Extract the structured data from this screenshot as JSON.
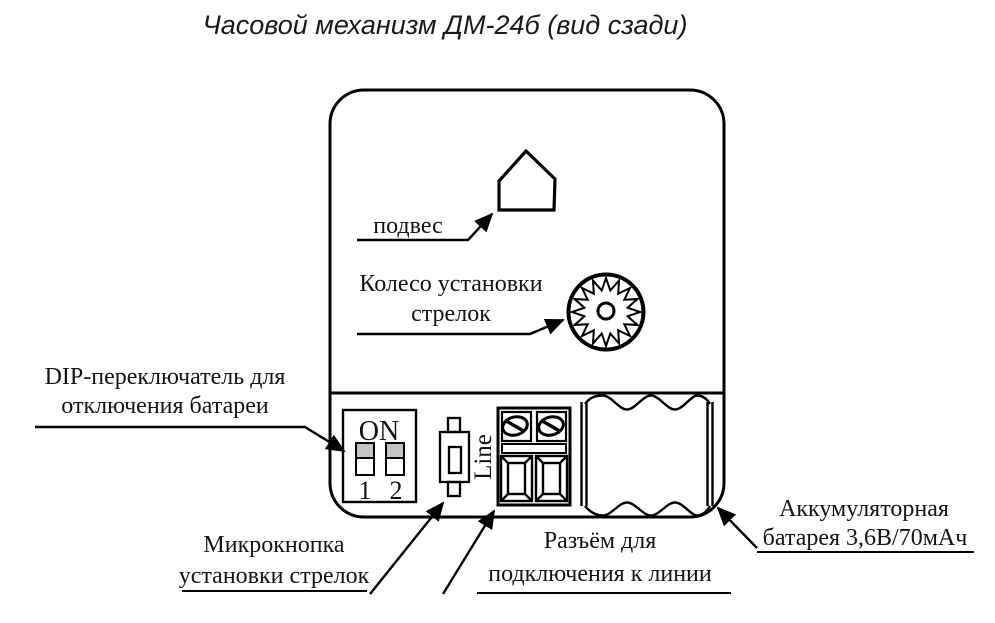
{
  "title": "Часовой механизм ДМ-24б (вид сзади)",
  "labels": {
    "hanger": "подвес",
    "wheel_1": "Колесо установки",
    "wheel_2": "стрелок",
    "dip_1": "DIP-переключатель для",
    "dip_2": "отключения батареи",
    "button_1": "Микрокнопка",
    "button_2": "установки стрелок",
    "connector_1": "Разъём для",
    "connector_2": "подключения к линии",
    "battery_1": "Аккумуляторная",
    "battery_2": "батарея 3,6В/70мАч"
  },
  "dip_switch": {
    "on": "ON",
    "pos1": "1",
    "pos2": "2"
  },
  "terminal": {
    "label": "Line"
  },
  "colors": {
    "ink": "#000000",
    "switch_fill": "#c3c3c3",
    "background": "#ffffff"
  }
}
